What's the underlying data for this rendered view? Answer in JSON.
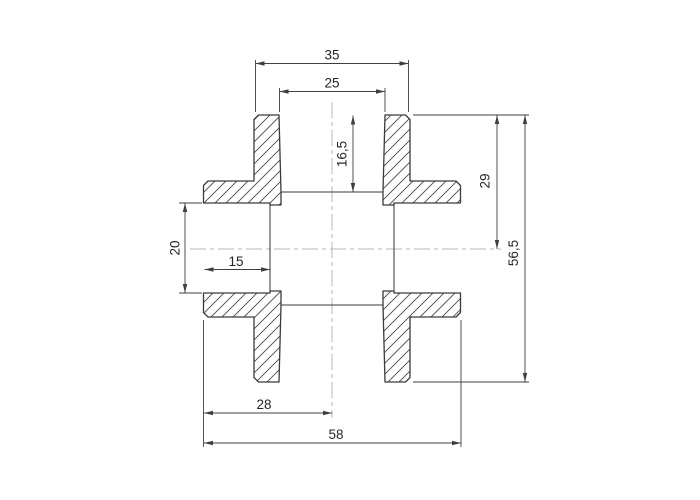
{
  "drawing": {
    "dimensions": {
      "top_outer_width": "35",
      "top_bore_width": "25",
      "top_socket_depth": "16,5",
      "top_face_to_center": "29",
      "overall_height": "56,5",
      "side_bore_height": "20",
      "side_socket_depth": "15",
      "left_face_to_center": "28",
      "overall_width": "58"
    },
    "colors": {
      "line": "#3b3b3b",
      "dimension": "#3f3f3f",
      "hatch": "#4a4a4a",
      "text": "#262626",
      "centerline": "#b3b7b9",
      "background": "#ffffff"
    }
  }
}
